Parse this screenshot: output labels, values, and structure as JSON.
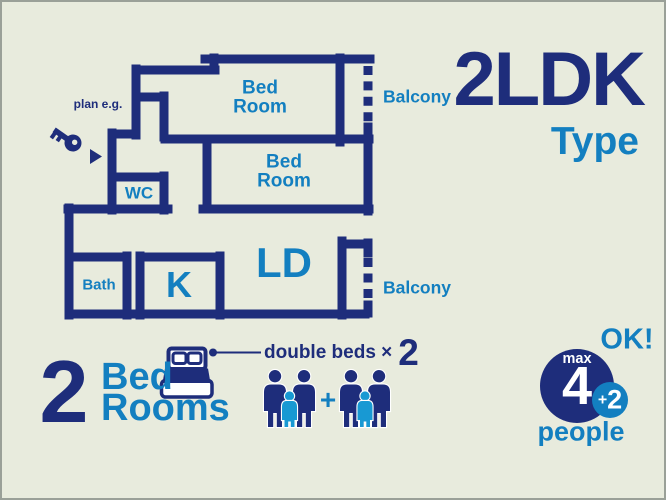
{
  "colors": {
    "background": "#e8ebdd",
    "navy": "#1e2d7b",
    "blue": "#137fc0",
    "cyan": "#1899d3",
    "white": "#ffffff",
    "frame": "#9aa098"
  },
  "plan": {
    "note": "plan e.g.",
    "rooms": {
      "bedroom1_line1": "Bed",
      "bedroom1_line2": "Room",
      "bedroom2_line1": "Bed",
      "bedroom2_line2": "Room",
      "wc": "WC",
      "bath": "Bath",
      "kitchen": "K",
      "living_dining": "LD",
      "balcony_top": "Balcony",
      "balcony_bottom": "Balcony"
    },
    "icons": {
      "key": "key-icon",
      "entrance_arrow": "triangle-right-icon",
      "balcony_opening": "dashed-door-line"
    }
  },
  "title": {
    "main": "2LDK",
    "sub": "Type"
  },
  "summary": {
    "count": "2",
    "room_line1": "Bed",
    "room_line2": "Rooms",
    "beds_label": "double beds ×",
    "beds_count": "2",
    "plus": "+",
    "icons": {
      "bed": "double-bed-icon",
      "adult": "adult-person-icon",
      "child": "child-person-icon"
    }
  },
  "capacity": {
    "ok": "OK!",
    "max_label": "max",
    "max_value": "4",
    "extra_plus": "+",
    "extra_value": "2",
    "unit": "people"
  }
}
